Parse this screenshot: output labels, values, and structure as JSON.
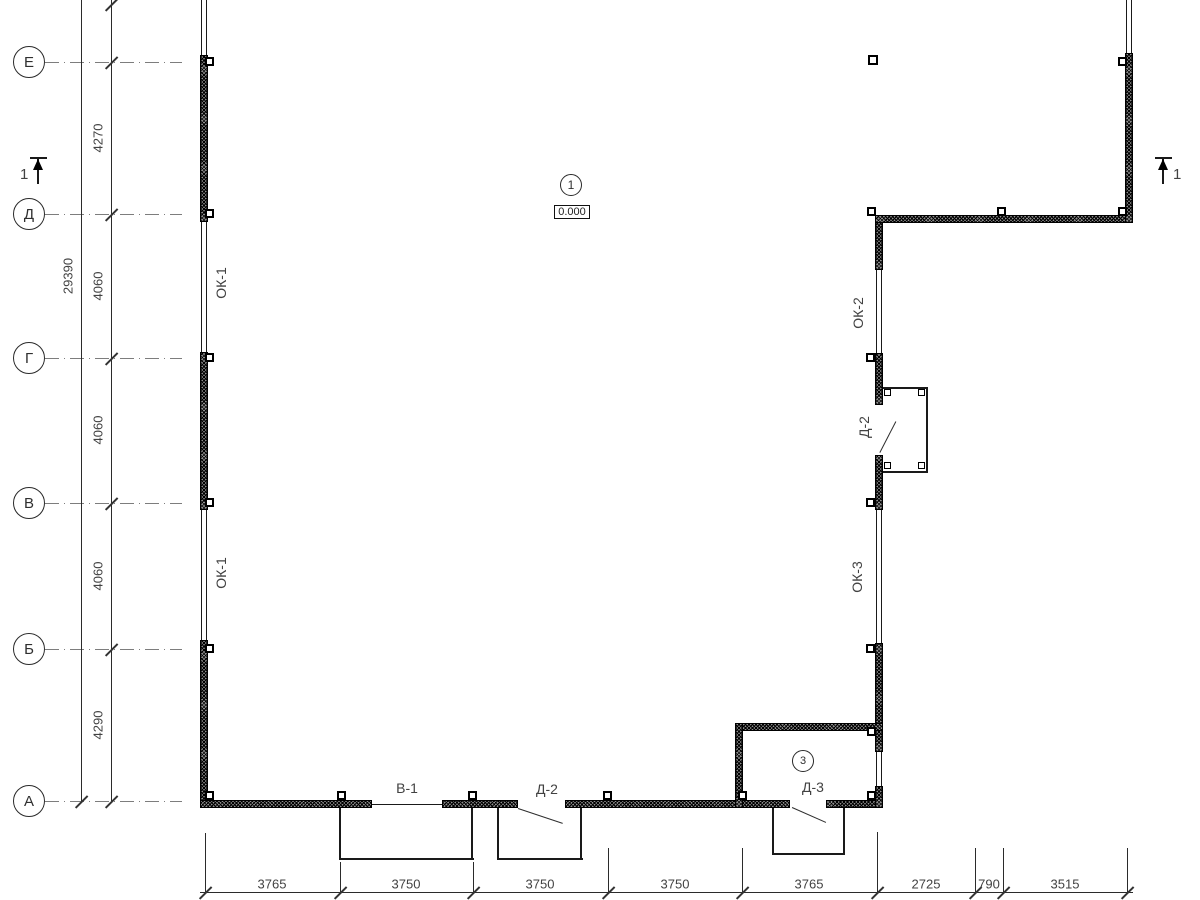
{
  "drawing_title": "floor-plan",
  "markers": {
    "plan_marker": {
      "number": "1",
      "x": 571,
      "y": 185,
      "r": 11
    },
    "elevation": {
      "text": "0.000",
      "x": 554,
      "y": 205,
      "w": 36,
      "h": 14
    },
    "room_marker": {
      "number": "3",
      "x": 803,
      "y": 761,
      "r": 11
    }
  },
  "section_marks": [
    {
      "label": "1",
      "bar": [
        30,
        157,
        17,
        2
      ],
      "line": [
        37,
        159,
        2,
        25
      ],
      "tri": [
        33,
        159
      ],
      "txt": [
        20,
        166
      ]
    },
    {
      "label": "1",
      "bar": [
        1155,
        157,
        17,
        2
      ],
      "line": [
        1162,
        159,
        2,
        25
      ],
      "tri": [
        1158,
        159
      ],
      "txt": [
        1173,
        166
      ]
    }
  ],
  "axes": {
    "circles": [
      {
        "label": "Е",
        "y": 62
      },
      {
        "label": "Д",
        "y": 214
      },
      {
        "label": "Г",
        "y": 358
      },
      {
        "label": "В",
        "y": 503
      },
      {
        "label": "Б",
        "y": 649
      },
      {
        "label": "А",
        "y": 801
      }
    ],
    "line_x": 45,
    "line_w": 137
  },
  "dims_left": {
    "overall": {
      "text": "29390",
      "x": 68,
      "y": 276
    },
    "bay_text_x": 98,
    "bays": [
      {
        "text": "4270",
        "y": 138
      },
      {
        "text": "4060",
        "y": 286
      },
      {
        "text": "4060",
        "y": 430
      },
      {
        "text": "4060",
        "y": 576
      },
      {
        "text": "4290",
        "y": 725
      }
    ]
  },
  "dims_bottom": {
    "text_y": 884,
    "items": [
      {
        "text": "3765",
        "x": 272
      },
      {
        "text": "3750",
        "x": 406
      },
      {
        "text": "3750",
        "x": 540
      },
      {
        "text": "3750",
        "x": 675
      },
      {
        "text": "3765",
        "x": 809
      },
      {
        "text": "2725",
        "x": 926
      },
      {
        "text": "790",
        "x": 989
      },
      {
        "text": "3515",
        "x": 1065
      }
    ]
  },
  "labels": {
    "rotated": [
      {
        "text": "ОК-1",
        "x": 221,
        "y": 283
      },
      {
        "text": "ОК-1",
        "x": 221,
        "y": 573
      },
      {
        "text": "ОК-2",
        "x": 858,
        "y": 313
      },
      {
        "text": "ОК-3",
        "x": 857,
        "y": 577
      },
      {
        "text": "Д-2",
        "x": 864,
        "y": 427
      }
    ],
    "horizontal": [
      {
        "text": "В-1",
        "x": 407,
        "y": 788
      },
      {
        "text": "Д-2",
        "x": 547,
        "y": 789
      },
      {
        "text": "Д-3",
        "x": 813,
        "y": 787
      }
    ]
  },
  "geometry": {
    "walls": [
      [
        200,
        55,
        8,
        167
      ],
      [
        200,
        352,
        8,
        158
      ],
      [
        200,
        640,
        8,
        168
      ],
      [
        200,
        800,
        172,
        8
      ],
      [
        442,
        800,
        76,
        8
      ],
      [
        565,
        800,
        225,
        8
      ],
      [
        826,
        800,
        57,
        8
      ],
      [
        875,
        215,
        8,
        55
      ],
      [
        875,
        353,
        8,
        52
      ],
      [
        875,
        455,
        8,
        55
      ],
      [
        875,
        643,
        8,
        109
      ],
      [
        875,
        786,
        8,
        22
      ],
      [
        875,
        215,
        258,
        8
      ],
      [
        1125,
        53,
        8,
        170
      ],
      [
        735,
        723,
        148,
        8
      ],
      [
        735,
        723,
        8,
        85
      ]
    ],
    "windows": [
      [
        201,
        0,
        55
      ],
      [
        201,
        222,
        130
      ],
      [
        201,
        510,
        130
      ],
      [
        876,
        270,
        83
      ],
      [
        876,
        510,
        133
      ],
      [
        876,
        752,
        34
      ],
      [
        1126,
        0,
        53
      ]
    ],
    "plines": [
      [
        339,
        808,
        2,
        52
      ],
      [
        339,
        858,
        135,
        2
      ],
      [
        471,
        808,
        2,
        52
      ],
      [
        497,
        808,
        2,
        52
      ],
      [
        497,
        858,
        86,
        2
      ],
      [
        580,
        808,
        2,
        52
      ],
      [
        772,
        808,
        2,
        47
      ],
      [
        772,
        853,
        73,
        2
      ],
      [
        843,
        808,
        2,
        47
      ],
      [
        883,
        387,
        45,
        2
      ],
      [
        926,
        387,
        2,
        86
      ],
      [
        883,
        471,
        45,
        2
      ],
      [
        372,
        804,
        70,
        1
      ]
    ],
    "leaves": [
      {
        "x": 518,
        "y": 808,
        "len": 47,
        "a": 18.4
      },
      {
        "x": 792,
        "y": 807,
        "len": 37,
        "a": 23.8
      },
      {
        "x": 880,
        "y": 452,
        "len": 35,
        "a": -62.7
      }
    ],
    "squares": [
      [
        205,
        57,
        9,
        2
      ],
      [
        205,
        209,
        9,
        2
      ],
      [
        205,
        353,
        9,
        2
      ],
      [
        205,
        498,
        9,
        2
      ],
      [
        205,
        644,
        9,
        2
      ],
      [
        205,
        791,
        9,
        2
      ],
      [
        337,
        791,
        9,
        2
      ],
      [
        468,
        791,
        9,
        2
      ],
      [
        603,
        791,
        9,
        2
      ],
      [
        738,
        791,
        9,
        2
      ],
      [
        867,
        791,
        9,
        2
      ],
      [
        867,
        207,
        9,
        2
      ],
      [
        997,
        207,
        9,
        2
      ],
      [
        1118,
        207,
        9,
        2
      ],
      [
        1118,
        57,
        9,
        2
      ],
      [
        866,
        353,
        9,
        2
      ],
      [
        866,
        498,
        9,
        2
      ],
      [
        866,
        644,
        9,
        2
      ],
      [
        867,
        727,
        9,
        2
      ],
      [
        868,
        55,
        10,
        2.5
      ],
      [
        884,
        389,
        7,
        1.5
      ],
      [
        918,
        389,
        7,
        1.5
      ],
      [
        884,
        462,
        7,
        1.5
      ],
      [
        918,
        462,
        7,
        1.5
      ]
    ],
    "dim_lines": [
      [
        81,
        0,
        1,
        801
      ],
      [
        111,
        0,
        1,
        801
      ],
      [
        200,
        892,
        933,
        1
      ]
    ],
    "ext_lines": [
      [
        205,
        833,
        60
      ],
      [
        340,
        862,
        31
      ],
      [
        473,
        862,
        31
      ],
      [
        608,
        848,
        45
      ],
      [
        742,
        848,
        45
      ],
      [
        877,
        832,
        61
      ],
      [
        975,
        848,
        45
      ],
      [
        1003,
        848,
        45
      ],
      [
        1127,
        848,
        45
      ]
    ],
    "ticks": [
      [
        205,
        892
      ],
      [
        340,
        892
      ],
      [
        473,
        892
      ],
      [
        608,
        892
      ],
      [
        742,
        892
      ],
      [
        877,
        892
      ],
      [
        975,
        892
      ],
      [
        1003,
        892
      ],
      [
        1127,
        892
      ],
      [
        111,
        4
      ],
      [
        111,
        62
      ],
      [
        111,
        214
      ],
      [
        111,
        358
      ],
      [
        111,
        503
      ],
      [
        111,
        649
      ],
      [
        111,
        801
      ],
      [
        81,
        801
      ]
    ]
  }
}
